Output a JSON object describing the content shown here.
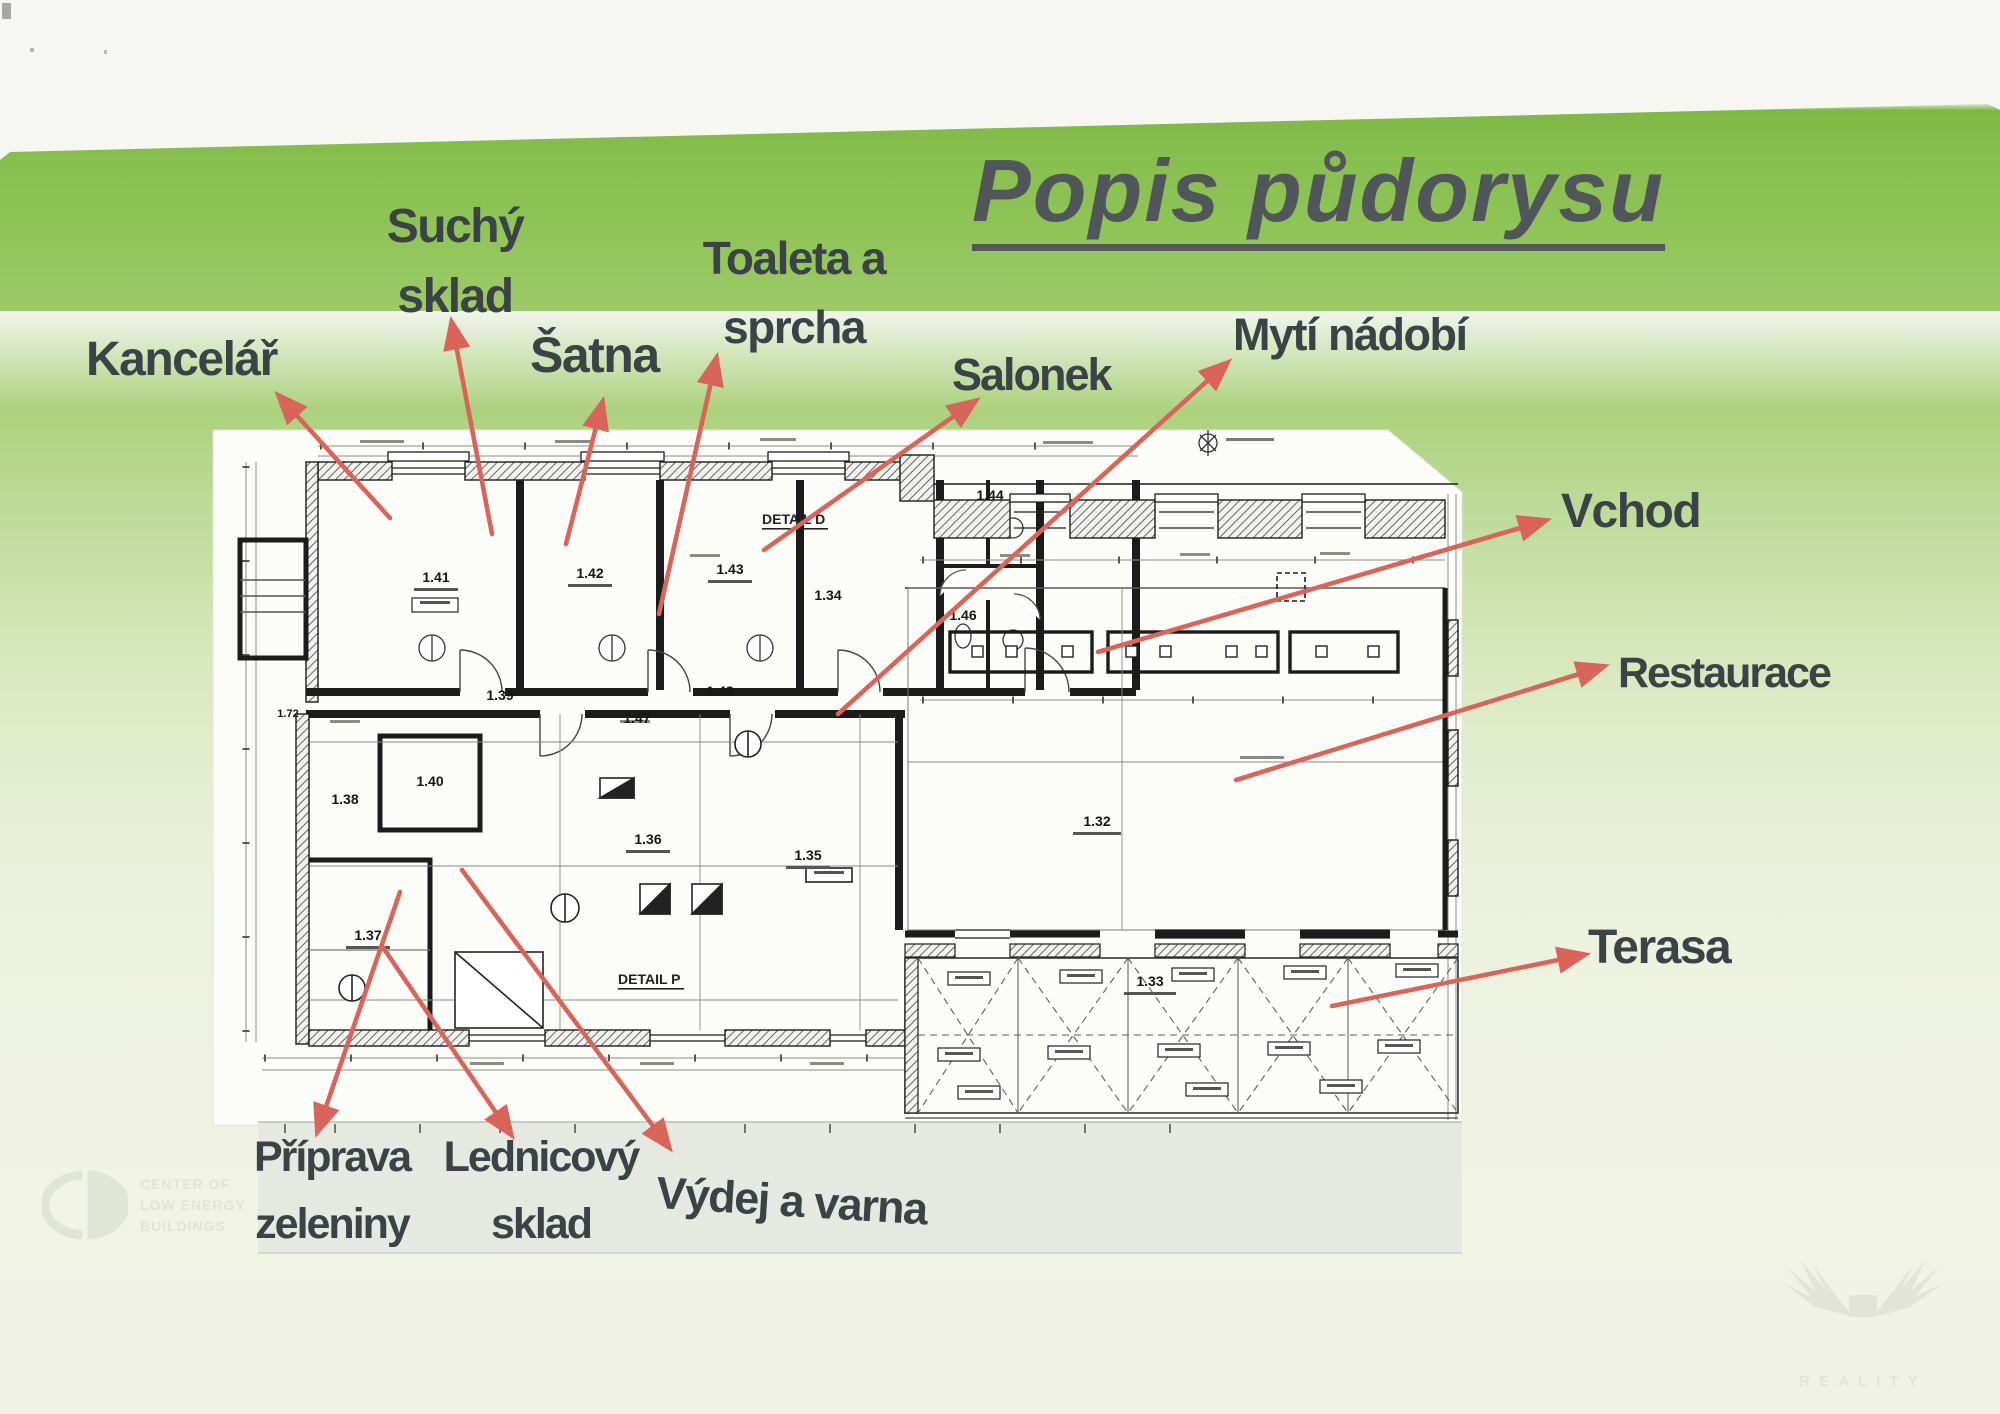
{
  "page": {
    "title": "Popis půdorysu",
    "colors": {
      "paper_green": "#87bf4e",
      "arrow_red": "#d9655a",
      "label_text": "#3c4347",
      "title_text": "#51565b",
      "plan_line": "#1c1c1c"
    }
  },
  "annotations": {
    "kancelar": "Kancelář",
    "suchy_sklad_line1": "Suchý",
    "suchy_sklad_line2": "sklad",
    "satna": "Šatna",
    "toaleta_line1": "Toaleta a",
    "toaleta_line2": "sprcha",
    "salonek": "Salonek",
    "myti_nadobi": "Mytí nádobí",
    "vchod": "Vchod",
    "restaurace": "Restaurace",
    "terasa": "Terasa",
    "priprava_line1": "Příprava",
    "priprava_line2": "zeleniny",
    "lednicovy_line1": "Lednicový",
    "lednicovy_line2": "sklad",
    "vydej": "Výdej a varna"
  },
  "plan": {
    "rooms": {
      "r141": "1.41",
      "r142": "1.42",
      "r143": "1.43",
      "r144": "1.44",
      "r146": "1.46",
      "r147": "1.47",
      "r148": "1.48",
      "r134": "1.34",
      "r139": "1.39",
      "r140": "1.40",
      "r138": "1.38",
      "r137": "1.37",
      "r136": "1.36",
      "r135": "1.35",
      "r132": "1.32",
      "r133": "1.33",
      "r172": "1.72"
    },
    "detail_d": "DETAIL D",
    "detail_p": "DETAIL P"
  },
  "watermarks": {
    "cleb_line1": "CENTER OF",
    "cleb_line2": "LOW ENERGY",
    "cleb_line3": "BUILDINGS",
    "corner": "REALITY"
  }
}
